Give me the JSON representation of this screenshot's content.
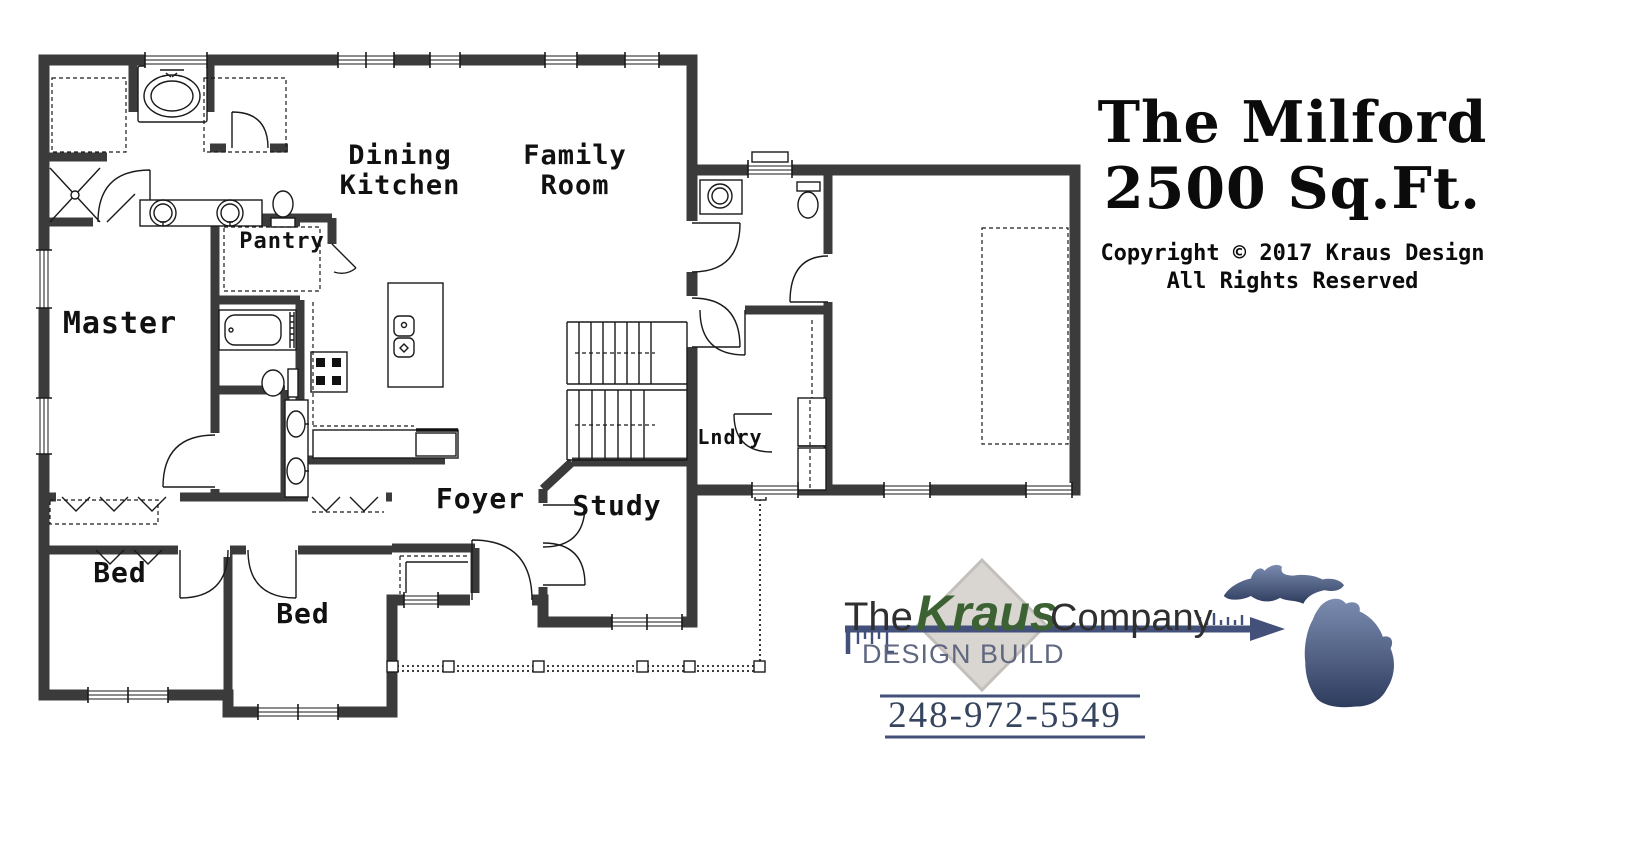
{
  "title_block": {
    "line1": "The Milford",
    "line2": "2500 Sq.Ft.",
    "copyright_line1": "Copyright © 2017 Kraus Design",
    "copyright_line2": "All Rights Reserved"
  },
  "floor_plan": {
    "wall_color": "#3b3b3b",
    "line_color": "#1a1a1a",
    "rooms": {
      "dining_kitchen": {
        "line1": "Dining",
        "line2": "Kitchen"
      },
      "family_room": {
        "line1": "Family",
        "line2": "Room"
      },
      "pantry": {
        "label": "Pantry"
      },
      "master": {
        "label": "Master"
      },
      "laundry": {
        "label": "Lndry"
      },
      "foyer": {
        "label": "Foyer"
      },
      "study": {
        "label": "Study"
      },
      "bedroom_left": {
        "label": "Bed"
      },
      "bedroom_right": {
        "label": "Bed"
      }
    }
  },
  "brand": {
    "word_the": "The",
    "word_kraus": "Kraus",
    "word_company": "Company",
    "tagline": "DESIGN BUILD",
    "phone": "248-972-5549",
    "colors": {
      "kraus_green": "#3c6233",
      "navy": "#42507a",
      "diamond_fill": "#d9d5d0",
      "diamond_edge": "#c3bfba",
      "tagline_gray": "#5f6880",
      "text_dark": "#2f2f2f",
      "phone_navy": "#36445f"
    }
  },
  "michigan_logo": {
    "gradient_top": "#7b8cb0",
    "gradient_bottom": "#2e3c5e"
  }
}
